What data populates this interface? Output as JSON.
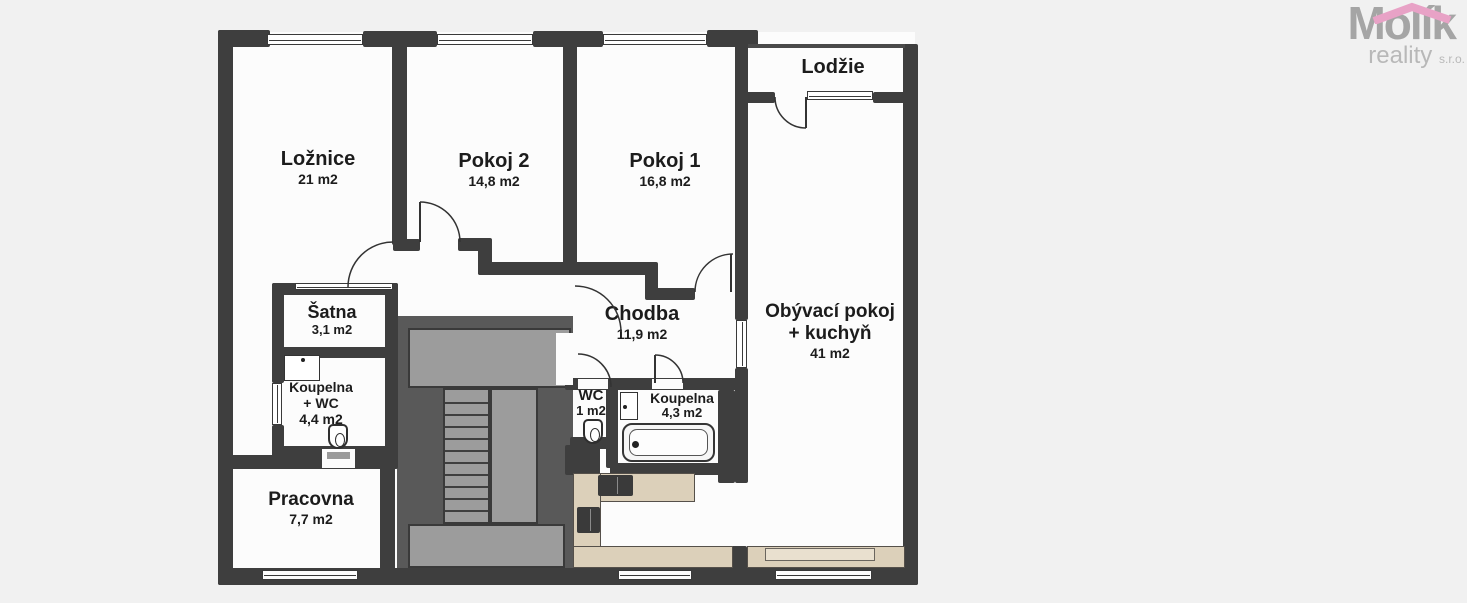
{
  "colors": {
    "bg": "#f1f1f1",
    "wall": "#3e3e3e",
    "core": "#595959",
    "stair": "#9c9c9c",
    "floor": "#fcfcfc",
    "counter": "#dcd0ba",
    "label": "#1c1c1c",
    "logoMain": "#a5a5a5",
    "logoSub": "#b8b8b8",
    "roof": "#e8a2c6",
    "arc": "#333333"
  },
  "logo": {
    "name": "Molík",
    "line2": "reality",
    "suffix": "s.r.o."
  },
  "rooms": [
    {
      "id": "loznice",
      "cx": 318,
      "y": 148,
      "lines": [
        {
          "t": "Ložnice",
          "s": 20
        },
        {
          "t": "21 m2",
          "s": 14
        }
      ]
    },
    {
      "id": "pokoj2",
      "cx": 494,
      "y": 150,
      "lines": [
        {
          "t": "Pokoj 2",
          "s": 20
        },
        {
          "t": "14,8 m2",
          "s": 14
        }
      ]
    },
    {
      "id": "pokoj1",
      "cx": 665,
      "y": 150,
      "lines": [
        {
          "t": "Pokoj 1",
          "s": 20
        },
        {
          "t": "16,8 m2",
          "s": 14
        }
      ]
    },
    {
      "id": "lodzie",
      "cx": 833,
      "y": 56,
      "lines": [
        {
          "t": "Lodžie",
          "s": 20
        }
      ]
    },
    {
      "id": "chodba",
      "cx": 642,
      "y": 303,
      "lines": [
        {
          "t": "Chodba",
          "s": 20
        },
        {
          "t": "11,9 m2",
          "s": 14
        }
      ]
    },
    {
      "id": "obyvaci-pokoj",
      "cx": 830,
      "y": 301,
      "lines": [
        {
          "t": "Obývací pokoj",
          "s": 19
        },
        {
          "t": "+ kuchyň",
          "s": 19
        },
        {
          "t": "41 m2",
          "s": 14
        }
      ]
    },
    {
      "id": "satna",
      "cx": 332,
      "y": 302,
      "lines": [
        {
          "t": "Šatna",
          "s": 18
        },
        {
          "t": "3,1 m2",
          "s": 13
        }
      ]
    },
    {
      "id": "koupelna-wc",
      "cx": 321,
      "y": 379,
      "lines": [
        {
          "t": "Koupelna",
          "s": 14
        },
        {
          "t": "+ WC",
          "s": 14
        },
        {
          "t": "4,4 m2",
          "s": 14
        }
      ]
    },
    {
      "id": "wc",
      "cx": 591,
      "y": 387,
      "lines": [
        {
          "t": "WC",
          "s": 15
        },
        {
          "t": "1 m2",
          "s": 13
        }
      ]
    },
    {
      "id": "koupelna",
      "cx": 682,
      "y": 390,
      "lines": [
        {
          "t": "Koupelna",
          "s": 14
        },
        {
          "t": "4,3 m2",
          "s": 13
        }
      ]
    },
    {
      "id": "pracovna",
      "cx": 311,
      "y": 489,
      "lines": [
        {
          "t": "Pracovna",
          "s": 19
        },
        {
          "t": "7,7 m2",
          "s": 14
        }
      ]
    }
  ],
  "plan": {
    "floor": [
      [
        224,
        32,
        691,
        548
      ],
      [
        748,
        46,
        157,
        58
      ]
    ],
    "core": [
      [
        397,
        316,
        176,
        252
      ]
    ],
    "stairs": {
      "landings": [
        [
          408,
          328,
          163,
          60
        ],
        [
          408,
          524,
          157,
          44
        ]
      ],
      "flights": [
        {
          "r": [
            443,
            388,
            47,
            136
          ],
          "treads": 10
        },
        {
          "r": [
            490,
            388,
            48,
            136
          ],
          "treads": 0
        }
      ]
    },
    "walls": [
      [
        218,
        30,
        15,
        555
      ],
      [
        218,
        30,
        52,
        17
      ],
      [
        363,
        31,
        74,
        16
      ],
      [
        533,
        31,
        70,
        16
      ],
      [
        707,
        30,
        51,
        17
      ],
      [
        903,
        44,
        15,
        541
      ],
      [
        218,
        568,
        700,
        17
      ],
      [
        392,
        40,
        15,
        205
      ],
      [
        563,
        40,
        14,
        232
      ],
      [
        393,
        239,
        27,
        12
      ],
      [
        458,
        238,
        24,
        13
      ],
      [
        478,
        238,
        14,
        37
      ],
      [
        478,
        262,
        170,
        13
      ],
      [
        645,
        262,
        13,
        33
      ],
      [
        645,
        288,
        50,
        12
      ],
      [
        735,
        44,
        13,
        276
      ],
      [
        735,
        368,
        13,
        115
      ],
      [
        742,
        92,
        33,
        11
      ],
      [
        873,
        92,
        32,
        11
      ],
      [
        272,
        283,
        126,
        12
      ],
      [
        272,
        283,
        12,
        100
      ],
      [
        272,
        425,
        12,
        35
      ],
      [
        385,
        283,
        13,
        177
      ],
      [
        275,
        347,
        112,
        11
      ],
      [
        272,
        446,
        126,
        14
      ],
      [
        218,
        455,
        180,
        14
      ],
      [
        380,
        457,
        15,
        113
      ],
      [
        565,
        378,
        183,
        12
      ],
      [
        606,
        378,
        12,
        90
      ],
      [
        570,
        437,
        48,
        12
      ],
      [
        565,
        445,
        35,
        30
      ],
      [
        610,
        463,
        124,
        12
      ],
      [
        718,
        390,
        17,
        93
      ],
      [
        731,
        546,
        16,
        24
      ]
    ],
    "thin": [
      [
        748,
        44,
        157,
        4
      ]
    ],
    "openings": [
      [
        578,
        379,
        30,
        10
      ],
      [
        652,
        379,
        31,
        10
      ],
      [
        322,
        449,
        33,
        19
      ],
      [
        556,
        333,
        17,
        52
      ]
    ],
    "windows": [
      [
        267,
        34,
        96,
        11,
        "h"
      ],
      [
        437,
        34,
        96,
        11,
        "h"
      ],
      [
        603,
        34,
        104,
        11,
        "h"
      ],
      [
        262,
        570,
        96,
        10,
        "h"
      ],
      [
        618,
        570,
        74,
        10,
        "h"
      ],
      [
        775,
        570,
        97,
        10,
        "h"
      ],
      [
        807,
        91,
        66,
        9,
        "h"
      ],
      [
        736,
        320,
        11,
        48,
        "v"
      ],
      [
        272,
        383,
        10,
        42,
        "v"
      ],
      [
        295,
        283,
        98,
        7,
        "h"
      ]
    ],
    "doors": [
      {
        "c": [
          393,
          287
        ],
        "r": 45,
        "a": [
          180,
          270
        ]
      },
      {
        "c": [
          420,
          242
        ],
        "r": 40,
        "a": [
          270,
          360
        ],
        "panel": [
          420,
          202,
          420,
          242
        ]
      },
      {
        "c": [
          733,
          292
        ],
        "r": 38,
        "a": [
          180,
          270
        ],
        "panel": [
          731,
          254,
          731,
          292
        ]
      },
      {
        "c": [
          806,
          97
        ],
        "r": 31,
        "a": [
          90,
          180
        ],
        "panel": [
          806,
          97,
          806,
          128
        ]
      },
      {
        "c": [
          575,
          332
        ],
        "r": 46,
        "a": [
          270,
          360
        ]
      },
      {
        "c": [
          578,
          387
        ],
        "r": 33,
        "a": [
          270,
          360
        ]
      },
      {
        "c": [
          655,
          383
        ],
        "r": 28,
        "a": [
          270,
          360
        ],
        "panel": [
          655,
          355,
          655,
          383
        ]
      }
    ],
    "counters": [
      [
        575,
        473,
        120,
        29
      ],
      [
        573,
        473,
        28,
        77
      ],
      [
        573,
        546,
        160,
        22
      ],
      [
        747,
        546,
        158,
        22
      ]
    ],
    "sideboard": [
      765,
      548,
      110,
      13
    ],
    "appliances": [
      [
        598,
        475,
        35,
        21
      ],
      [
        577,
        507,
        23,
        26
      ]
    ],
    "bathtub": {
      "x": 622,
      "y": 423,
      "w": 93,
      "h": 39
    },
    "toilets": [
      [
        328,
        424
      ],
      [
        583,
        419
      ]
    ],
    "sinks": [
      [
        284,
        355,
        36,
        26,
        "h"
      ],
      [
        620,
        392,
        18,
        28,
        "v"
      ]
    ],
    "thresholds": [
      [
        327,
        452,
        23,
        7
      ]
    ]
  }
}
